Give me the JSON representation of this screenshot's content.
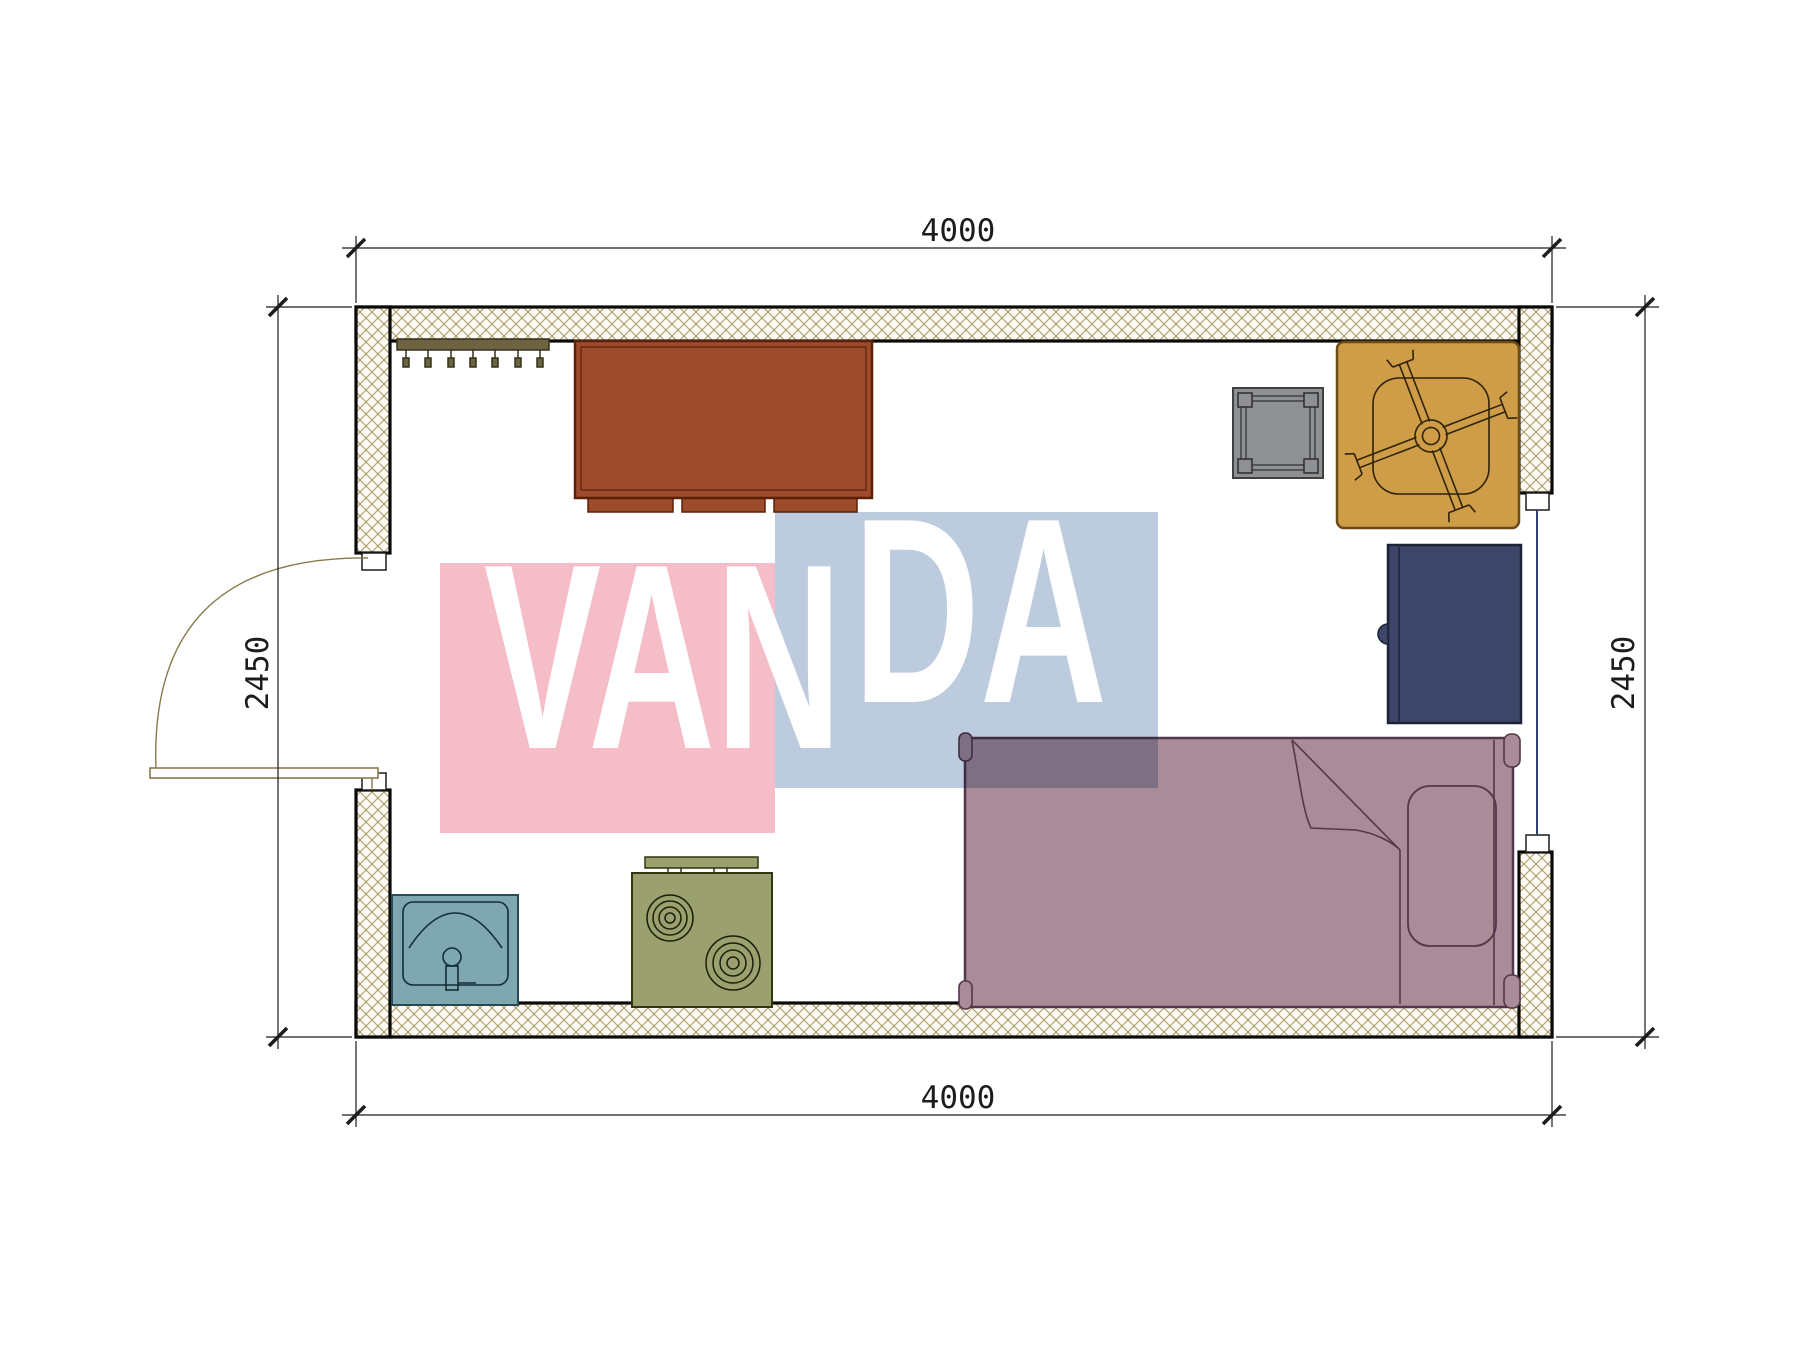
{
  "drawing": {
    "type": "floor-plan",
    "room": {
      "width_label": "4000",
      "height_label": "2450"
    }
  },
  "dimensions": {
    "top": {
      "value": "4000"
    },
    "bottom": {
      "value": "4000"
    },
    "left": {
      "value": "2450"
    },
    "right": {
      "value": "2450"
    }
  },
  "watermark": {
    "text": "VANDA",
    "part1": "VAN",
    "part2": "DA",
    "pink": "#f4bdc8",
    "blue": "#bdcbdf",
    "text_color": "#ffffff"
  },
  "colors": {
    "wall_hatch_line": "#ab9766",
    "wall_fill": "#fcfaf3",
    "wall_stroke": "#0a0a0a",
    "dim_line": "#1c1c1c",
    "door_line": "#8a7a4a",
    "window_glass": "#31406e"
  },
  "furniture": [
    {
      "name": "coat-rack",
      "color": "#6c6340"
    },
    {
      "name": "wardrobe",
      "color": "#9d4b2b"
    },
    {
      "name": "side-table",
      "color": "#8f9092"
    },
    {
      "name": "chair-mat",
      "color": "#cf9c48"
    },
    {
      "name": "nightstand",
      "color": "#3d4569"
    },
    {
      "name": "bed",
      "color": "#a98c97"
    },
    {
      "name": "stove",
      "color": "#9aa06e"
    },
    {
      "name": "sink",
      "color": "#7ea7b2"
    }
  ]
}
